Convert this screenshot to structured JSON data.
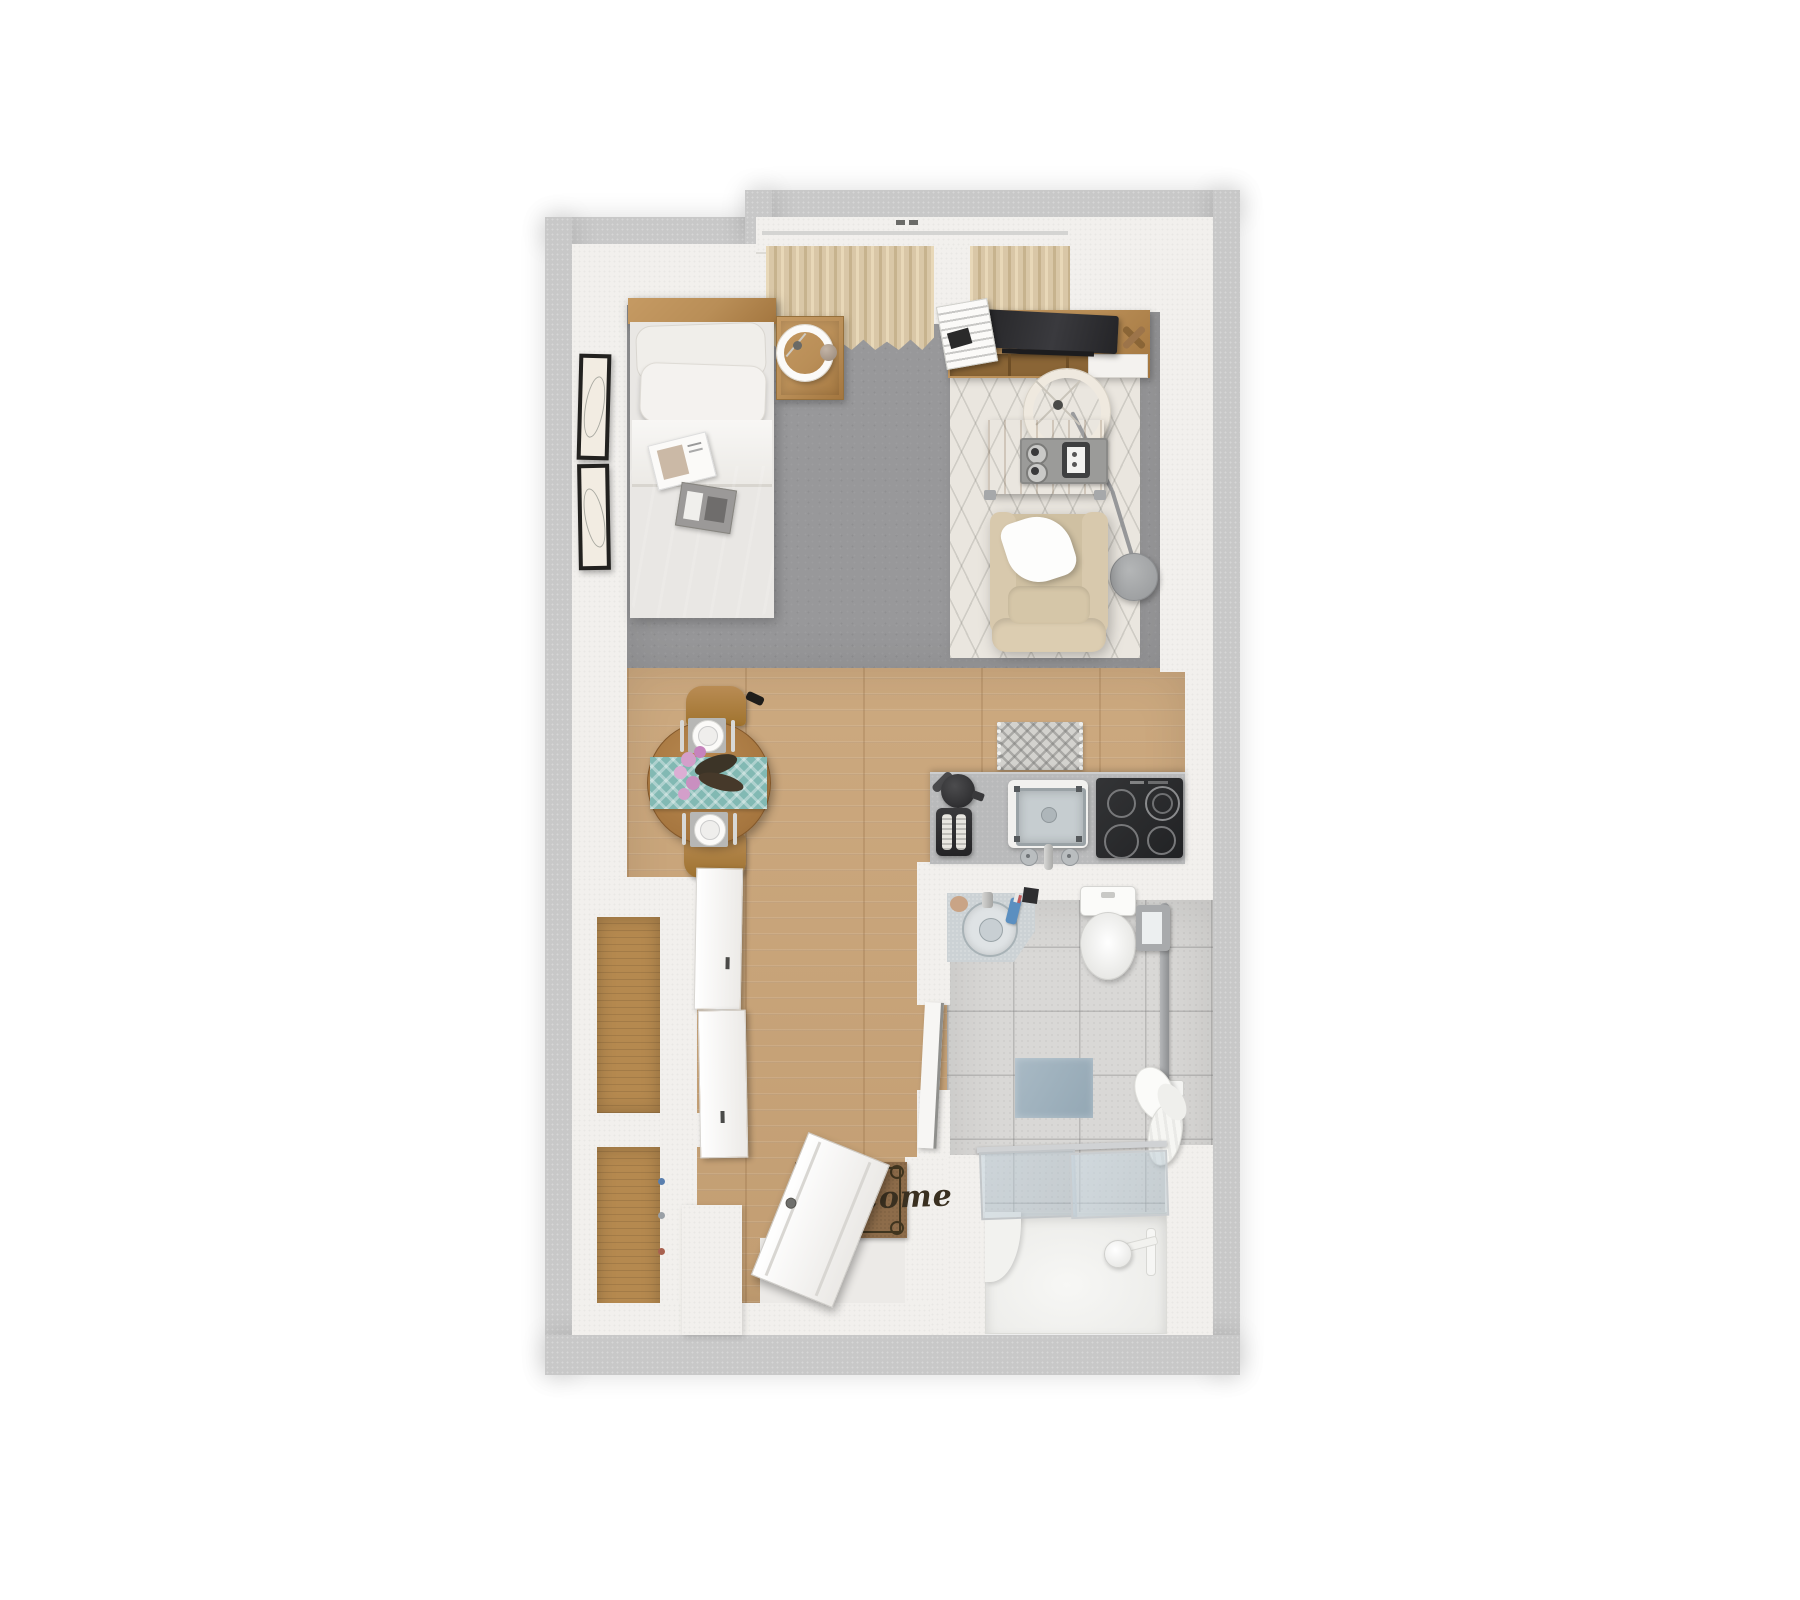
{
  "palette": {
    "outer": "#c8c8c8",
    "wall": "#f2f0ed",
    "carpet": "#98989a",
    "wood": "#c9a478",
    "wood-dark": "#b5894f",
    "tile": "#d9d8d6",
    "rug": "#eae6df",
    "counter": "#b9babb",
    "appliance-dark": "#2d2e30",
    "furniture-wood": "#b98e57",
    "table-wood": "#ae7f47",
    "duvet": "#c6b6a8",
    "linen": "#f3f1ee",
    "chair-fabric": "#d6c7ab",
    "curtain": "#d9c7a7",
    "runner": "#82b9b3",
    "mat-brown": "#8d6c4a",
    "mat-text": "#3a3020",
    "bath-mat-blue": "#a3b5c0",
    "vanity": "#ccd2d5",
    "glass": "#b7c7d1",
    "metal": "#a2a4a6",
    "flower-pink": "#d39fca"
  },
  "rooms": {
    "bedroom": {
      "furniture": [
        "bed",
        "pillows",
        "duvet",
        "magazines",
        "nightstand",
        "table-lamp",
        "wall-art-frames",
        "window-curtains"
      ]
    },
    "living": {
      "furniture": [
        "tv-console",
        "tv",
        "magazine-stack",
        "area-rug",
        "coffee-table",
        "serving-tray",
        "armchair",
        "throw-pillow",
        "arc-floor-lamp"
      ]
    },
    "dining": {
      "furniture": [
        "round-table",
        "table-runner",
        "dining-chairs",
        "place-settings",
        "flowers"
      ]
    },
    "kitchen": {
      "furniture": [
        "counter",
        "kettle",
        "toaster",
        "sink",
        "cooktop",
        "kitchen-mat"
      ]
    },
    "bathroom": {
      "furniture": [
        "vanity-basin",
        "toilet",
        "grab-bar",
        "bath-mat",
        "towels",
        "shower-glass-doors",
        "shower-base",
        "shower-head"
      ]
    },
    "entry": {
      "mat_text": "Welcome",
      "furniture": [
        "welcome-mat",
        "front-door",
        "closets",
        "sliding-doors"
      ]
    }
  }
}
